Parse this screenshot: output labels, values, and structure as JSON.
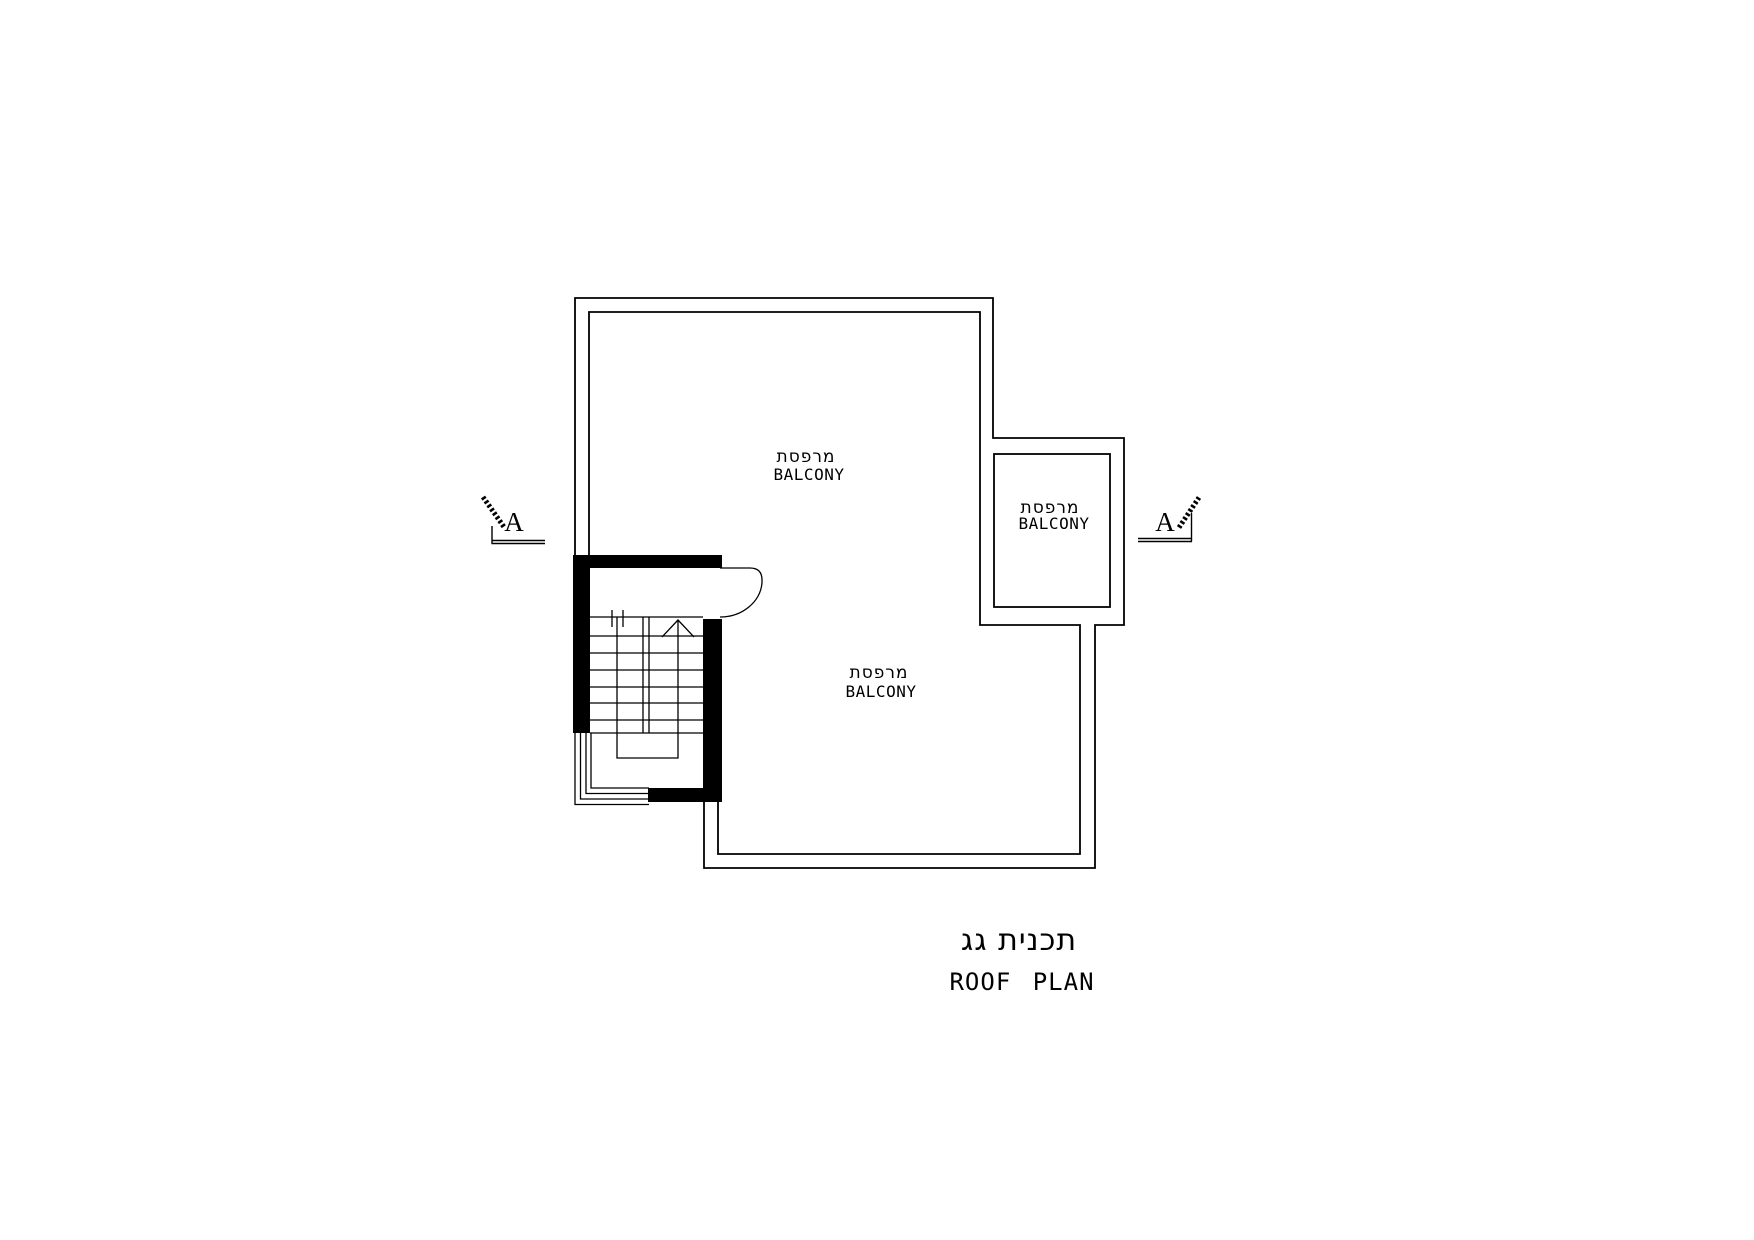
{
  "colors": {
    "line": "#000000",
    "background": "#ffffff"
  },
  "labels": {
    "balcony_top": {
      "hebrew": "מרפסת",
      "english": "BALCONY"
    },
    "balcony_right": {
      "hebrew": "מרפסת",
      "english": "BALCONY"
    },
    "balcony_middle": {
      "hebrew": "מרפסת",
      "english": "BALCONY"
    }
  },
  "section_markers": {
    "left": {
      "label": "A"
    },
    "right": {
      "label": "A"
    }
  },
  "title": {
    "hebrew": "תכנית גג",
    "english": "ROOF PLAN"
  }
}
